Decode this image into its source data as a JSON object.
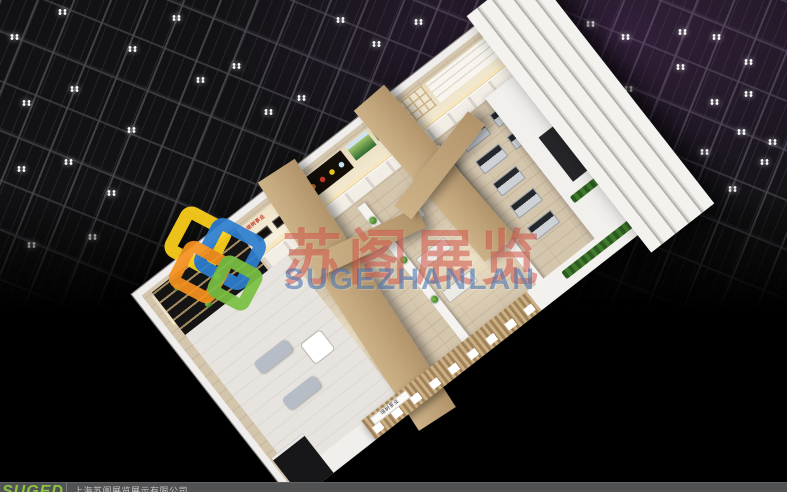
{
  "watermark": {
    "title_cn": "苏阁展览",
    "title_en": "SUGEZHANLAN",
    "cn_color": "rgba(203,66,52,0.5)",
    "en_color": "rgba(56,104,170,0.55)"
  },
  "booth": {
    "brand_sign": "培树茶业",
    "brand_color": "#c0392b"
  },
  "footer": {
    "logo_text": "SUGED",
    "logo_color": "#8dc63f",
    "company_name": "上海苏阁展览展示有限公司",
    "text_color": "#c6c6c6",
    "bar_color": "#515254"
  },
  "ceiling": {
    "tint_color": "rgba(118,62,138,0.32)",
    "bright_light": [
      487,
      37
    ],
    "light_positions": [
      [
        10,
        34
      ],
      [
        58,
        9
      ],
      [
        128,
        46
      ],
      [
        172,
        15
      ],
      [
        22,
        100
      ],
      [
        70,
        86
      ],
      [
        127,
        127
      ],
      [
        17,
        166
      ],
      [
        64,
        159
      ],
      [
        107,
        190
      ],
      [
        27,
        242
      ],
      [
        88,
        234
      ],
      [
        196,
        77
      ],
      [
        232,
        63
      ],
      [
        264,
        109
      ],
      [
        297,
        95
      ],
      [
        336,
        17
      ],
      [
        372,
        41
      ],
      [
        414,
        19
      ],
      [
        554,
        54
      ],
      [
        586,
        21
      ],
      [
        621,
        34
      ],
      [
        678,
        29
      ],
      [
        712,
        34
      ],
      [
        744,
        59
      ],
      [
        624,
        86
      ],
      [
        676,
        64
      ],
      [
        710,
        99
      ],
      [
        744,
        91
      ],
      [
        737,
        129
      ],
      [
        768,
        139
      ],
      [
        700,
        149
      ],
      [
        760,
        159
      ],
      [
        652,
        185
      ],
      [
        728,
        186
      ]
    ]
  }
}
